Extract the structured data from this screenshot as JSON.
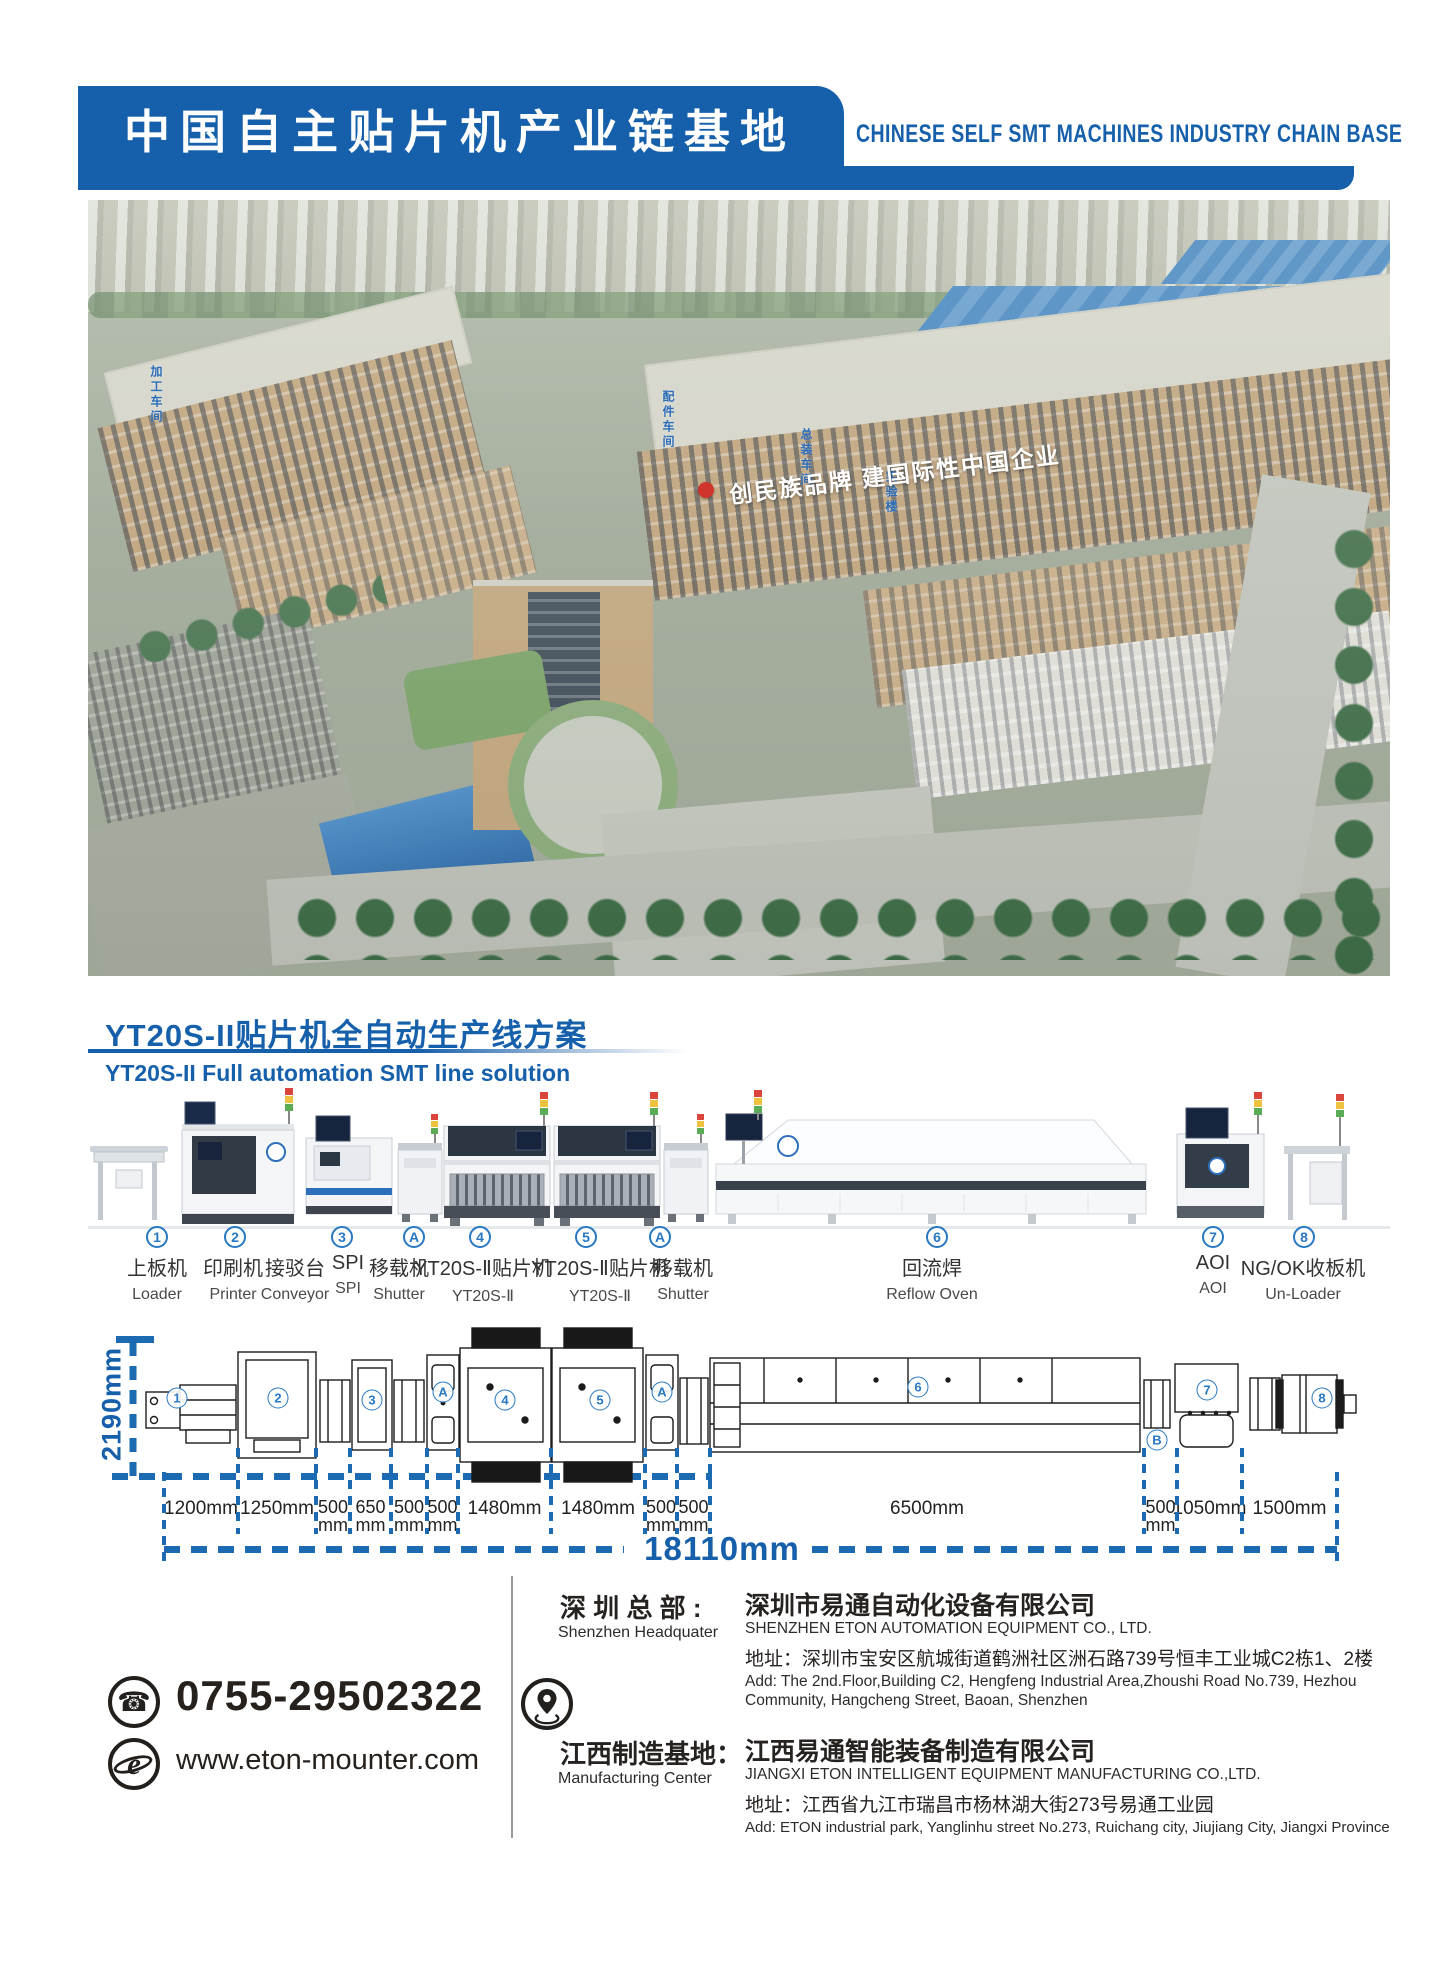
{
  "header": {
    "title_zh": "中国自主贴片机产业链基地",
    "title_en": "CHINESE SELF SMT MACHINES INDUSTRY CHAIN BASE"
  },
  "hero": {
    "slogan": "创民族品牌  建国际性中国企业",
    "signs": [
      "加工车间",
      "配件车间",
      "总装车间",
      "实验楼"
    ]
  },
  "section": {
    "title_zh": "YT20S-II贴片机全自动生产线方案",
    "title_en": "YT20S-II Full automation SMT line solution"
  },
  "line": {
    "markers": [
      {
        "s": "1",
        "x": 157
      },
      {
        "s": "2",
        "x": 235
      },
      {
        "s": "3",
        "x": 342
      },
      {
        "s": "A",
        "x": 414
      },
      {
        "s": "4",
        "x": 480
      },
      {
        "s": "5",
        "x": 586
      },
      {
        "s": "A",
        "x": 660
      },
      {
        "s": "6",
        "x": 937
      },
      {
        "s": "7",
        "x": 1213
      },
      {
        "s": "8",
        "x": 1304
      }
    ],
    "stations": [
      {
        "x": 157,
        "zh": "上板机",
        "en": "Loader"
      },
      {
        "x": 233,
        "zh": "印刷机",
        "en": "Printer"
      },
      {
        "x": 295,
        "zh": "接驳台",
        "en": "Conveyor"
      },
      {
        "x": 348,
        "zh": "SPI",
        "en": "SPI"
      },
      {
        "x": 399,
        "zh": "移载机",
        "en": "Shutter"
      },
      {
        "x": 483,
        "zh": "YT20S-Ⅱ贴片机",
        "en": "YT20S-Ⅱ"
      },
      {
        "x": 600,
        "zh": "YT20S-Ⅱ贴片机",
        "en": "YT20S-Ⅱ"
      },
      {
        "x": 683,
        "zh": "移载机",
        "en": "Shutter"
      },
      {
        "x": 932,
        "zh": "回流焊",
        "en": "Reflow Oven"
      },
      {
        "x": 1213,
        "zh": "AOI",
        "en": "AOI"
      },
      {
        "x": 1303,
        "zh": "NG/OK收板机",
        "en": "Un-Loader"
      }
    ]
  },
  "diagram": {
    "height_label": "2190mm",
    "total_label": "18110mm",
    "segments": [
      {
        "t": "1200mm",
        "x1": 164,
        "x2": 238,
        "narrow": false
      },
      {
        "t": "1250mm",
        "x1": 238,
        "x2": 316,
        "narrow": false
      },
      {
        "t": "500mm",
        "x1": 316,
        "x2": 350,
        "narrow": true
      },
      {
        "t": "650mm",
        "x1": 350,
        "x2": 391,
        "narrow": true
      },
      {
        "t": "500mm",
        "x1": 391,
        "x2": 427,
        "narrow": true
      },
      {
        "t": "500mm",
        "x1": 427,
        "x2": 458,
        "narrow": true
      },
      {
        "t": "1480mm",
        "x1": 458,
        "x2": 551,
        "narrow": false
      },
      {
        "t": "1480mm",
        "x1": 551,
        "x2": 645,
        "narrow": false
      },
      {
        "t": "500mm",
        "x1": 645,
        "x2": 677,
        "narrow": true
      },
      {
        "t": "500mm",
        "x1": 677,
        "x2": 710,
        "narrow": true
      },
      {
        "t": "6500mm",
        "x1": 710,
        "x2": 1144,
        "narrow": false
      },
      {
        "t": "500mm",
        "x1": 1144,
        "x2": 1177,
        "narrow": true
      },
      {
        "t": "1050mm",
        "x1": 1177,
        "x2": 1242,
        "narrow": false
      },
      {
        "t": "1500mm",
        "x1": 1242,
        "x2": 1337,
        "narrow": false
      }
    ],
    "marks": [
      {
        "s": "1",
        "x": 177,
        "y": 1398
      },
      {
        "s": "2",
        "x": 278,
        "y": 1398
      },
      {
        "s": "3",
        "x": 372,
        "y": 1400
      },
      {
        "s": "A",
        "x": 443,
        "y": 1392
      },
      {
        "s": "4",
        "x": 505,
        "y": 1400
      },
      {
        "s": "5",
        "x": 600,
        "y": 1400
      },
      {
        "s": "A",
        "x": 662,
        "y": 1392
      },
      {
        "s": "6",
        "x": 918,
        "y": 1387
      },
      {
        "s": "B",
        "x": 1157,
        "y": 1440
      },
      {
        "s": "7",
        "x": 1207,
        "y": 1390
      },
      {
        "s": "8",
        "x": 1322,
        "y": 1398
      }
    ]
  },
  "footer": {
    "phone": "0755-29502322",
    "website": "www.eton-mounter.com",
    "shenzhen": {
      "label_zh": "深 圳 总 部 :",
      "label_en": "Shenzhen Headquater",
      "company_zh": "深圳市易通自动化设备有限公司",
      "company_en": "SHENZHEN ETON AUTOMATION EQUIPMENT CO., LTD.",
      "addr_zh": "地址：深圳市宝安区航城街道鹤洲社区洲石路739号恒丰工业城C2栋1、2楼",
      "addr_en": "Add: The 2nd.Floor,Building C2, Hengfeng Industrial Area,Zhoushi Road No.739, Hezhou Community, Hangcheng Street, Baoan, Shenzhen"
    },
    "jiangxi": {
      "label_zh": "江西制造基地：",
      "label_en": "Manufacturing Center",
      "company_zh": "江西易通智能装备制造有限公司",
      "company_en": "JIANGXI ETON INTELLIGENT EQUIPMENT MANUFACTURING CO.,LTD.",
      "addr_zh": "地址：江西省九江市瑞昌市杨林湖大街273号易通工业园",
      "addr_en": "Add: ETON industrial park, Yanglinhu street No.273, Ruichang city, Jiujiang City, Jiangxi Province"
    }
  }
}
